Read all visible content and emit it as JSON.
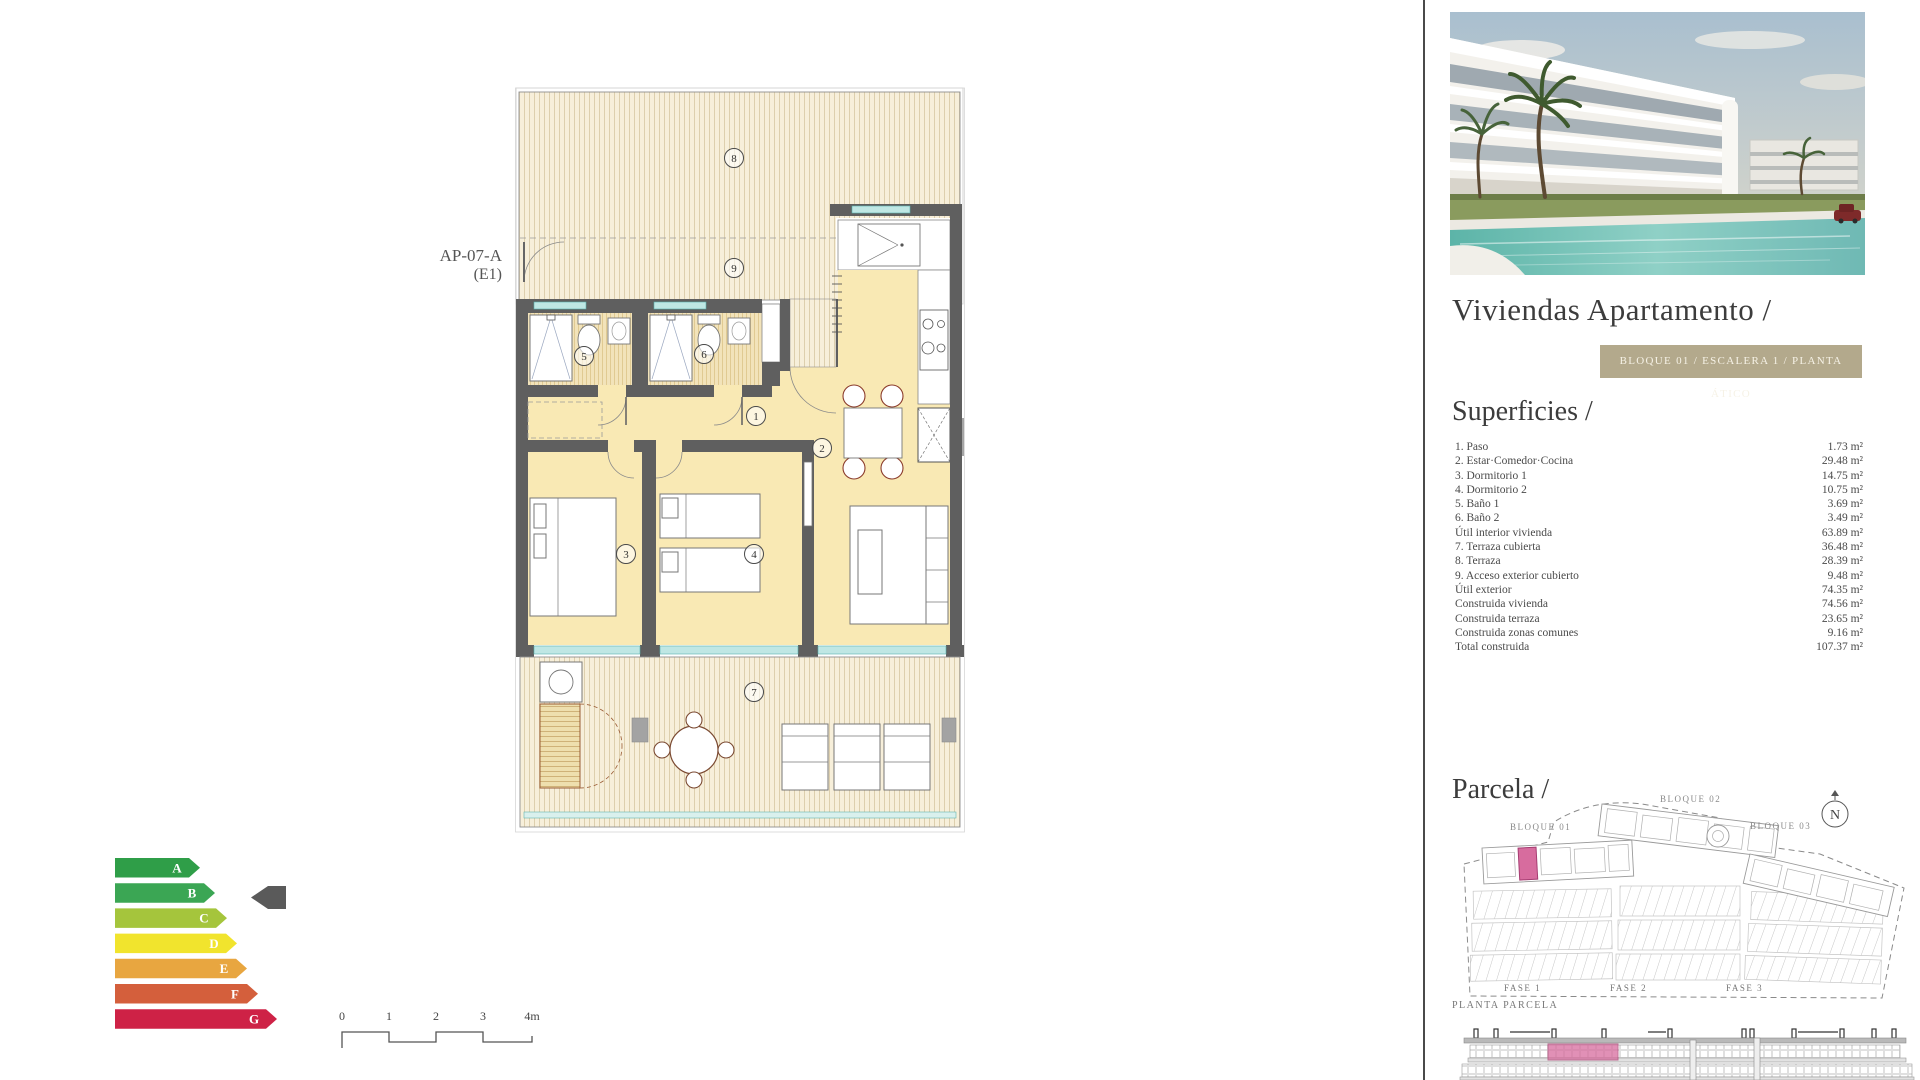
{
  "plan": {
    "unit_label": "AP-07-A",
    "unit_sub": "(E1)",
    "rooms": [
      "1",
      "2",
      "3",
      "4",
      "5",
      "6",
      "7",
      "8",
      "9"
    ]
  },
  "header": {
    "title": "Viviendas Apartamento /",
    "badge": "BLOQUE 01  / ESCALERA 1 / PLANTA ÁTICO",
    "badge_bg": "#b3a98c"
  },
  "superficies": {
    "heading": "Superficies /",
    "rows": [
      {
        "label": "1. Paso",
        "value": "1.73 m²"
      },
      {
        "label": "2. Estar·Comedor·Cocina",
        "value": "29.48 m²"
      },
      {
        "label": "3. Dormitorio 1",
        "value": "14.75 m²"
      },
      {
        "label": "4. Dormitorio 2",
        "value": "10.75 m²"
      },
      {
        "label": "5. Baño 1",
        "value": "3.69 m²"
      },
      {
        "label": "6. Baño 2",
        "value": "3.49 m²"
      },
      {
        "label": "Útil interior vivienda",
        "value": "63.89 m²"
      },
      {
        "label": "7. Terraza cubierta",
        "value": "36.48 m²"
      },
      {
        "label": "8. Terraza",
        "value": "28.39 m²"
      },
      {
        "label": "9. Acceso exterior cubierto",
        "value": "9.48 m²"
      },
      {
        "label": "Útil exterior",
        "value": "74.35 m²"
      },
      {
        "label": "Construida vivienda",
        "value": "74.56 m²"
      },
      {
        "label": "Construida terraza",
        "value": "23.65 m²"
      },
      {
        "label": "Construida zonas comunes",
        "value": "9.16 m²"
      },
      {
        "label": "Total construida",
        "value": "107.37 m²"
      }
    ]
  },
  "parcela": {
    "heading": "Parcela /",
    "bloque1": "BLOQUE 01",
    "bloque2": "BLOQUE 02",
    "bloque3": "BLOQUE 03",
    "fase1": "FASE 1",
    "fase2": "FASE 2",
    "fase3": "FASE 3",
    "north": "N",
    "caption": "PLANTA PARCELA",
    "highlight_color": "#d76c9e"
  },
  "energy": {
    "selected": "B",
    "grades": [
      {
        "letter": "A",
        "color": "#2f9e48",
        "width": 85
      },
      {
        "letter": "B",
        "color": "#3ba654",
        "width": 100
      },
      {
        "letter": "C",
        "color": "#a5c53c",
        "width": 112
      },
      {
        "letter": "D",
        "color": "#f1e42d",
        "width": 122
      },
      {
        "letter": "E",
        "color": "#e8a640",
        "width": 132
      },
      {
        "letter": "F",
        "color": "#d45f3c",
        "width": 143
      },
      {
        "letter": "G",
        "color": "#ce2246",
        "width": 162
      }
    ],
    "indicator_color": "#5a5a5a"
  },
  "scale_bar": {
    "ticks": [
      "0",
      "1",
      "2",
      "3",
      "4m"
    ]
  }
}
